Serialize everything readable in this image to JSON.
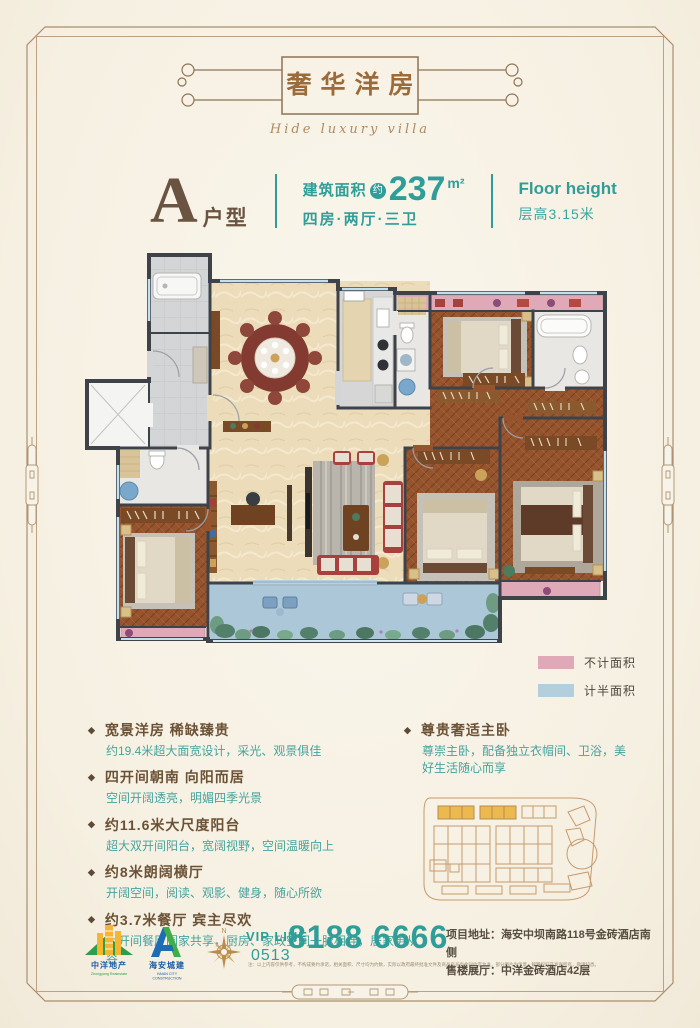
{
  "header": {
    "title": "奢华洋房",
    "subtitle": "Hide luxury villa"
  },
  "unit": {
    "letter": "A",
    "suffix": "户型",
    "area_label": "建筑面积",
    "approx_badge": "约",
    "area_value": "237",
    "area_unit": "m²",
    "layout": "四房·两厅·三卫",
    "floor_height_en": "Floor height",
    "floor_height_cn": "层高3.15米"
  },
  "legend": {
    "items": [
      {
        "label": "不计面积",
        "color": "#dfa9b8"
      },
      {
        "label": "计半面积",
        "color": "#b3cedd"
      }
    ]
  },
  "features": {
    "left": [
      {
        "heading": "宽景洋房 稀缺臻贵",
        "body": "约19.4米超大面宽设计，采光、观景俱佳"
      },
      {
        "heading": "四开间朝南 向阳而居",
        "body": "空间开阔透亮，明媚四季光景"
      },
      {
        "heading": "约11.6米大尺度阳台",
        "body": "超大双开间阳台，宽阔视野，空间温暖向上"
      },
      {
        "heading": "约8米朗阔横厅",
        "body": "开阔空间，阅读、观影、健身，随心所欲"
      },
      {
        "heading": "约3.7米餐厅 宾主尽欢",
        "body": "大开间餐厅阖家共享，厨房、家政空间一脉相连，居家更从容"
      }
    ],
    "right": [
      {
        "heading": "尊贵奢适主卧",
        "body": "尊崇主卧，配备独立衣帽间、卫浴，美好生活随心而享"
      }
    ],
    "bullet_glyph": "◆"
  },
  "footer": {
    "logo1": {
      "name": "中洋地产",
      "sub": "Zhongyang Realestate"
    },
    "logo2": {
      "name": "海安城建",
      "sub": "HAIAN CITY CONSTRUCTION"
    },
    "compass_n": "N",
    "vip_label": "VIP LINE",
    "vip_code": "0513",
    "phone": "8188 6666",
    "address_line1": "项目地址：海安中坝南路118号金砖酒店南侧",
    "address_line2": "售楼展厅：中洋金砖酒店42层",
    "disclaimer": "注：以上内容仅供参考，不构成要约承诺，相关面积、尺寸均为约数，实际以政府最终批准文件及商品房买卖合同约定为准，部分图片为示意，解释权归开发商所有，敬请知悉。"
  },
  "colors": {
    "accent_teal": "#2f9e98",
    "title_brown": "#9c6b3a",
    "heading_brown": "#6b5236",
    "legend_pink": "#dfa9b8",
    "legend_blue": "#b3cedd",
    "frame_line": "#b29876"
  }
}
